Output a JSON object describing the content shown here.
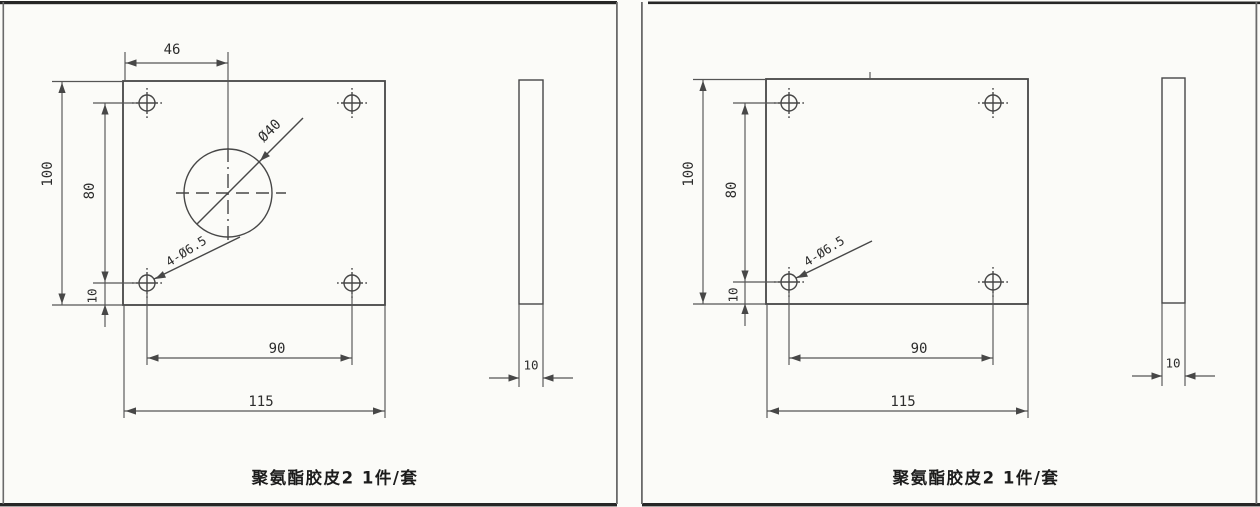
{
  "panels": [
    {
      "caption": "聚氨酯胶皮2 1件/套",
      "front_view": {
        "dim_top_width": "46",
        "dim_height": "100",
        "dim_hole_row_span": "80",
        "dim_hole_bottom_offset": "10",
        "dim_hole_col_span": "90",
        "dim_total_width": "115",
        "label_center_hole": "Ø40",
        "label_corner_holes": "4-Ø6.5"
      },
      "side_view": {
        "dim_thickness": "10"
      }
    },
    {
      "caption": "聚氨酯胶皮2 1件/套",
      "front_view": {
        "dim_height": "100",
        "dim_hole_row_span": "80",
        "dim_hole_bottom_offset": "10",
        "dim_hole_col_span": "90",
        "dim_total_width": "115",
        "label_corner_holes": "4-Ø6.5"
      },
      "side_view": {
        "dim_thickness": "10"
      }
    }
  ],
  "colors": {
    "line": "#474747",
    "text": "#2d2d2d",
    "border": "#262626",
    "background": "#fbfbf8"
  }
}
